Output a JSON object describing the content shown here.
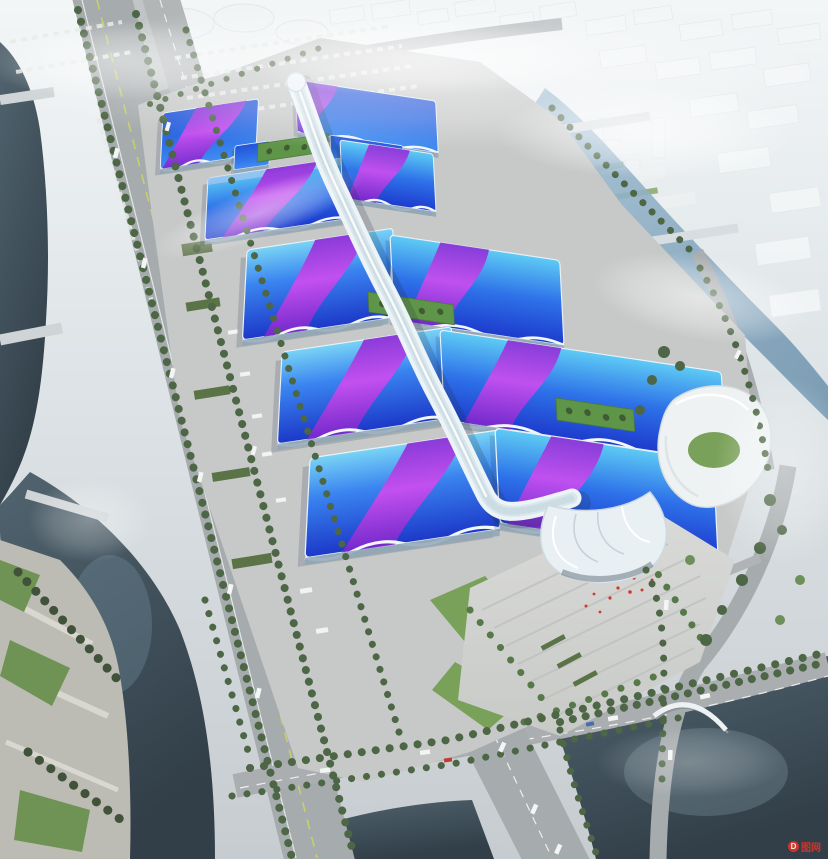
{
  "scene": {
    "type": "aerial-architectural-rendering",
    "subject": "Bird's-eye rendering of a mega exhibition & convention center: rows of wavy blue roofs with magenta ribbon stripes flank a sinuous white central concourse spine ending in a white shell canopy over a south entrance plaza, surrounded by highways, canals, lakes, parkland and a hazy white city",
    "landmarks": [
      "hazy-city",
      "north-river",
      "left-river",
      "left-lake",
      "right-lake",
      "elevated-highway",
      "south-boulevard",
      "south-avenue",
      "expo-site",
      "exhibition-halls",
      "green-roof-strips",
      "central-spine",
      "south-entrance-shell",
      "entrance-plaza",
      "swirl-building",
      "riverside-park",
      "fog"
    ]
  },
  "watermark": {
    "logo": "D",
    "text": "图网"
  },
  "palette": {
    "sky_top": "#f3f6f7",
    "sky_mid": "#dde3e6",
    "sky_low": "#c6cccf",
    "site": "#c7c9c8",
    "plaza_light": "#dadbd8",
    "plaza_dark": "#c8cac7",
    "road": "#a6abad",
    "road_shadow": "#8f9496",
    "lane_yellow": "#c9cf6a",
    "water_deep": "#323f49",
    "water_mid": "#51646f",
    "river_light": "#a3c0d4",
    "river_dark": "#7094ae",
    "tree": "#4d6645",
    "lawn": "#79a159",
    "green_roof": "#5f9549",
    "roof_cyan": "#5ecbf4",
    "roof_azure": "#2e72e9",
    "roof_deep": "#1d3bcd",
    "roof_navy": "#2353d9",
    "roof_light": "#3f8df2",
    "ribbon_violet": "#8c2ed6",
    "ribbon_magenta": "#cf4cf0",
    "spine_white": "#edf4f7",
    "spine_shade": "#c3d5dd",
    "accent_red": "#d0382e",
    "city_block": "#f4f7f8"
  }
}
